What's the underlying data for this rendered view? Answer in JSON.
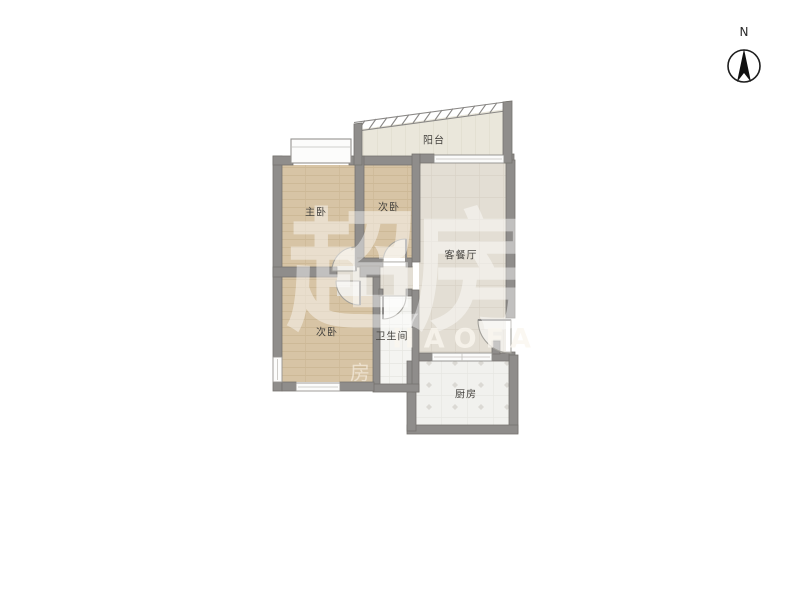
{
  "page": {
    "background": "#ffffff"
  },
  "compass": {
    "label": "N"
  },
  "floorplan": {
    "rooms": [
      {
        "id": "balcony",
        "label": "阳台"
      },
      {
        "id": "master-bedroom",
        "label": "主卧"
      },
      {
        "id": "bedroom-top",
        "label": "次卧"
      },
      {
        "id": "living-dining",
        "label": "客餐厅"
      },
      {
        "id": "bedroom-bottom",
        "label": "次卧"
      },
      {
        "id": "bathroom",
        "label": "卫生间"
      },
      {
        "id": "kitchen",
        "label": "厨房"
      }
    ],
    "colors": {
      "wall": "#8f8d8b",
      "wood_floor": "#d7c4a5",
      "greige_floor": "#e3ded4",
      "balcony_floor": "#eae7db",
      "bathroom_floor": "#f4f4f1",
      "kitchen_floor": "#f1f1ee",
      "label_text": "#45433f"
    }
  },
  "watermark": {
    "logo_text": "超房",
    "latin_text": "HAOFA",
    "small_text": "房"
  }
}
